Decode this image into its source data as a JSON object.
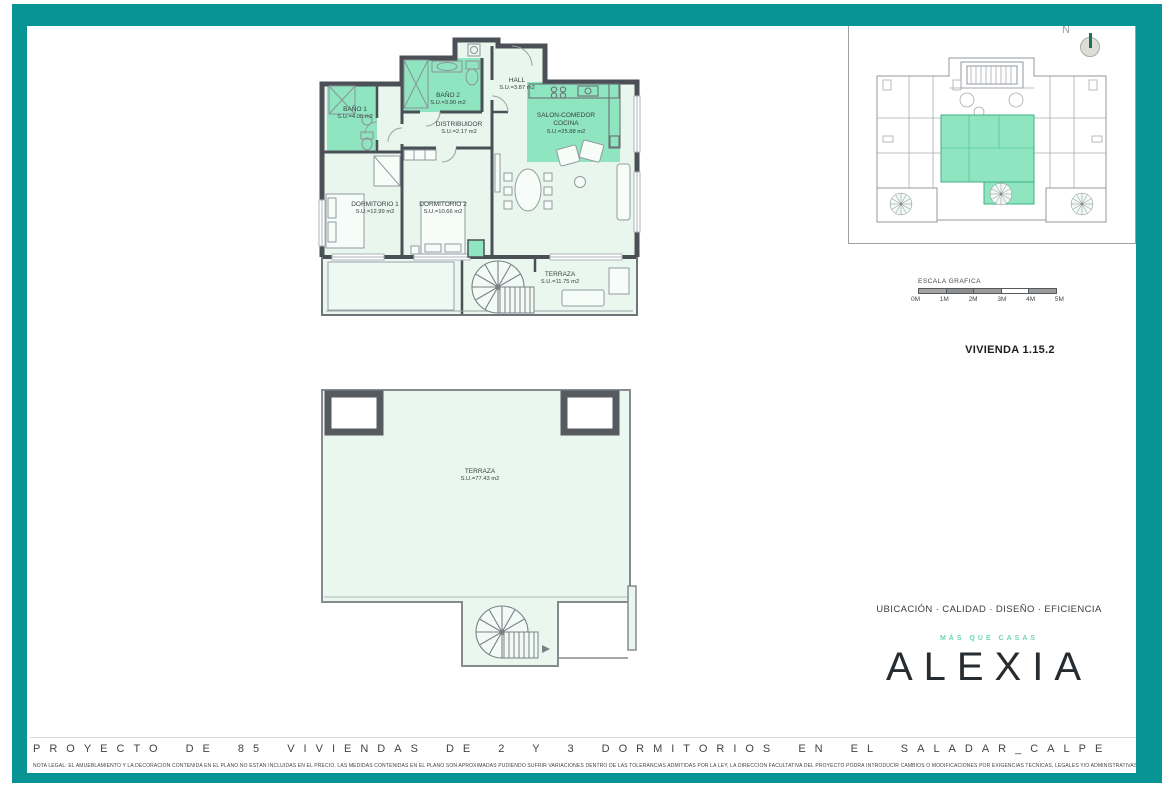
{
  "colors": {
    "frame_teal": "#089394",
    "room_green": "#8ee5c0",
    "room_light": "#e8f6ee",
    "wall": "#4a5056",
    "accent_mint": "#6fd7ac"
  },
  "floor_plan": {
    "rooms": [
      {
        "name": "BAÑO 1",
        "area": "S.U.=4.08 m2"
      },
      {
        "name": "BAÑO 2",
        "area": "S.U.=3.90 m2"
      },
      {
        "name": "HALL",
        "area": "S.U.=3.87 m2"
      },
      {
        "name": "DISTRIBUIDOR",
        "area": "S.U.=2.17 m2"
      },
      {
        "name": "SALON-COMEDOR",
        "name2": "COCINA",
        "area": "S.U.=25.88 m2"
      },
      {
        "name": "DORMITORIO 1",
        "area": "S.U.=12.99 m2"
      },
      {
        "name": "DORMITORIO 2",
        "area": "S.U.=10.66 m2"
      },
      {
        "name": "TERRAZA",
        "area": "S.U.=11.75 m2"
      }
    ]
  },
  "roof_plan": {
    "name": "TERRAZA",
    "area": "S.U.=77.43 m2"
  },
  "key_plan": {
    "north": "N"
  },
  "scale_bar": {
    "title": "ESCALA GRAFICA",
    "labels": [
      "0M",
      "1M",
      "2M",
      "3M",
      "4M",
      "5M"
    ]
  },
  "unit_title": "VIVIENDA 1.15.2",
  "branding": {
    "tagline": "UBICACIÓN · CALIDAD · DISEÑO · EFICIENCIA",
    "slogan": "MÁS QUE CASAS",
    "logo": "ALEXIA"
  },
  "footer": {
    "project_title": "PROYECTO DE 85 VIVIENDAS DE 2 Y 3 DORMITORIOS EN EL SALADAR_CALPE",
    "legal_note": "NOTA LEGAL: EL AMUEBLAMIENTO Y LA DECORACIÓN CONTENIDA EN EL PLANO NO ESTÁN INCLUIDAS EN EL PRECIO. LAS MEDIDAS CONTENIDAS EN EL PLANO SON APROXIMADAS PUDIENDO SUFRIR VARIACIONES DENTRO DE LAS TOLERANCIAS ADMITIDAS POR LA LEY, LA DIRECCIÓN FACULTATIVA DEL PROYECTO PODRÁ INTRODUCIR CAMBIOS O MODIFICACIONES POR EXIGENCIAS TÉCNICAS, LEGALES Y/O ADMINISTRATIVAS."
  }
}
